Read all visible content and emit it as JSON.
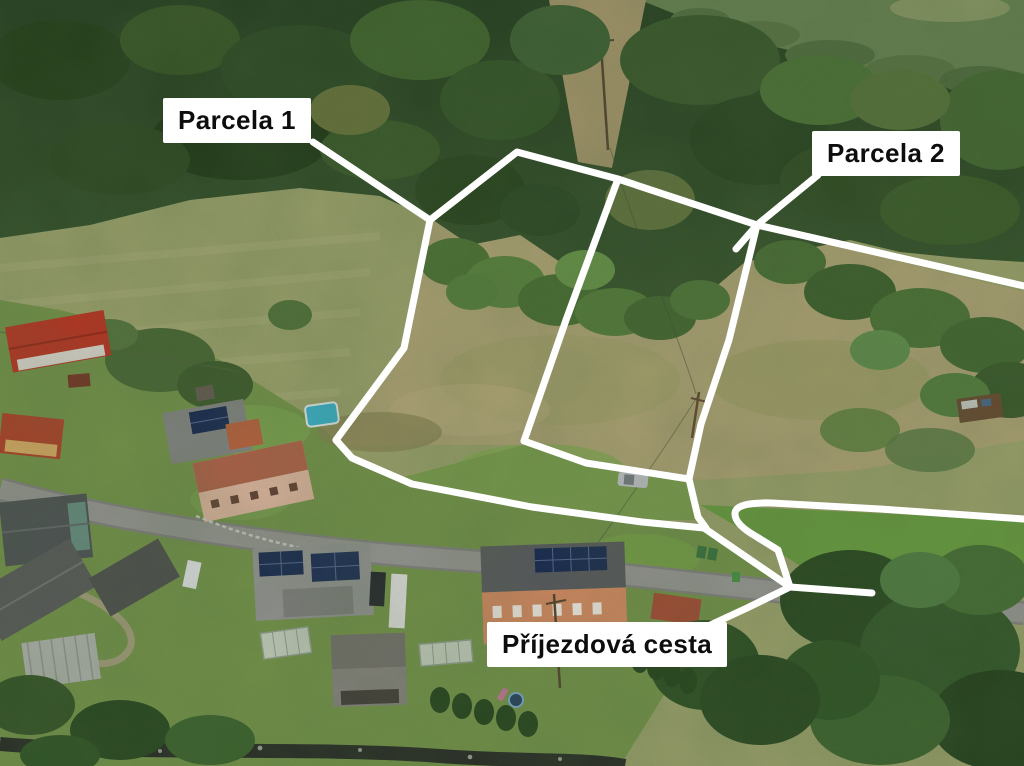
{
  "photo": {
    "alt": "Aerial drone photo of two grassland building parcels above a village street, outlined in white"
  },
  "annotations": {
    "parcel1": {
      "text": "Parcela 1"
    },
    "parcel2": {
      "text": "Parcela 2"
    },
    "road": {
      "text": "Příjezdová cesta"
    }
  },
  "colors": {
    "annotation_line": "#ffffff",
    "label_bg": "#ffffff",
    "label_text": "#0d0d0d",
    "forest_dark": "#2f4c2a",
    "forest_light": "#3c5a33",
    "meadow": "#a3ab72",
    "dry_grass": "#b6ac7b",
    "lawn": "#7b9c50",
    "road_surface": "#9f9f9b",
    "red_roof": "#c23b28",
    "salmon_wall": "#dd9368",
    "solar_panel": "#1e3058",
    "pool_water": "#3fbcd6",
    "stream": "#2e332b"
  }
}
